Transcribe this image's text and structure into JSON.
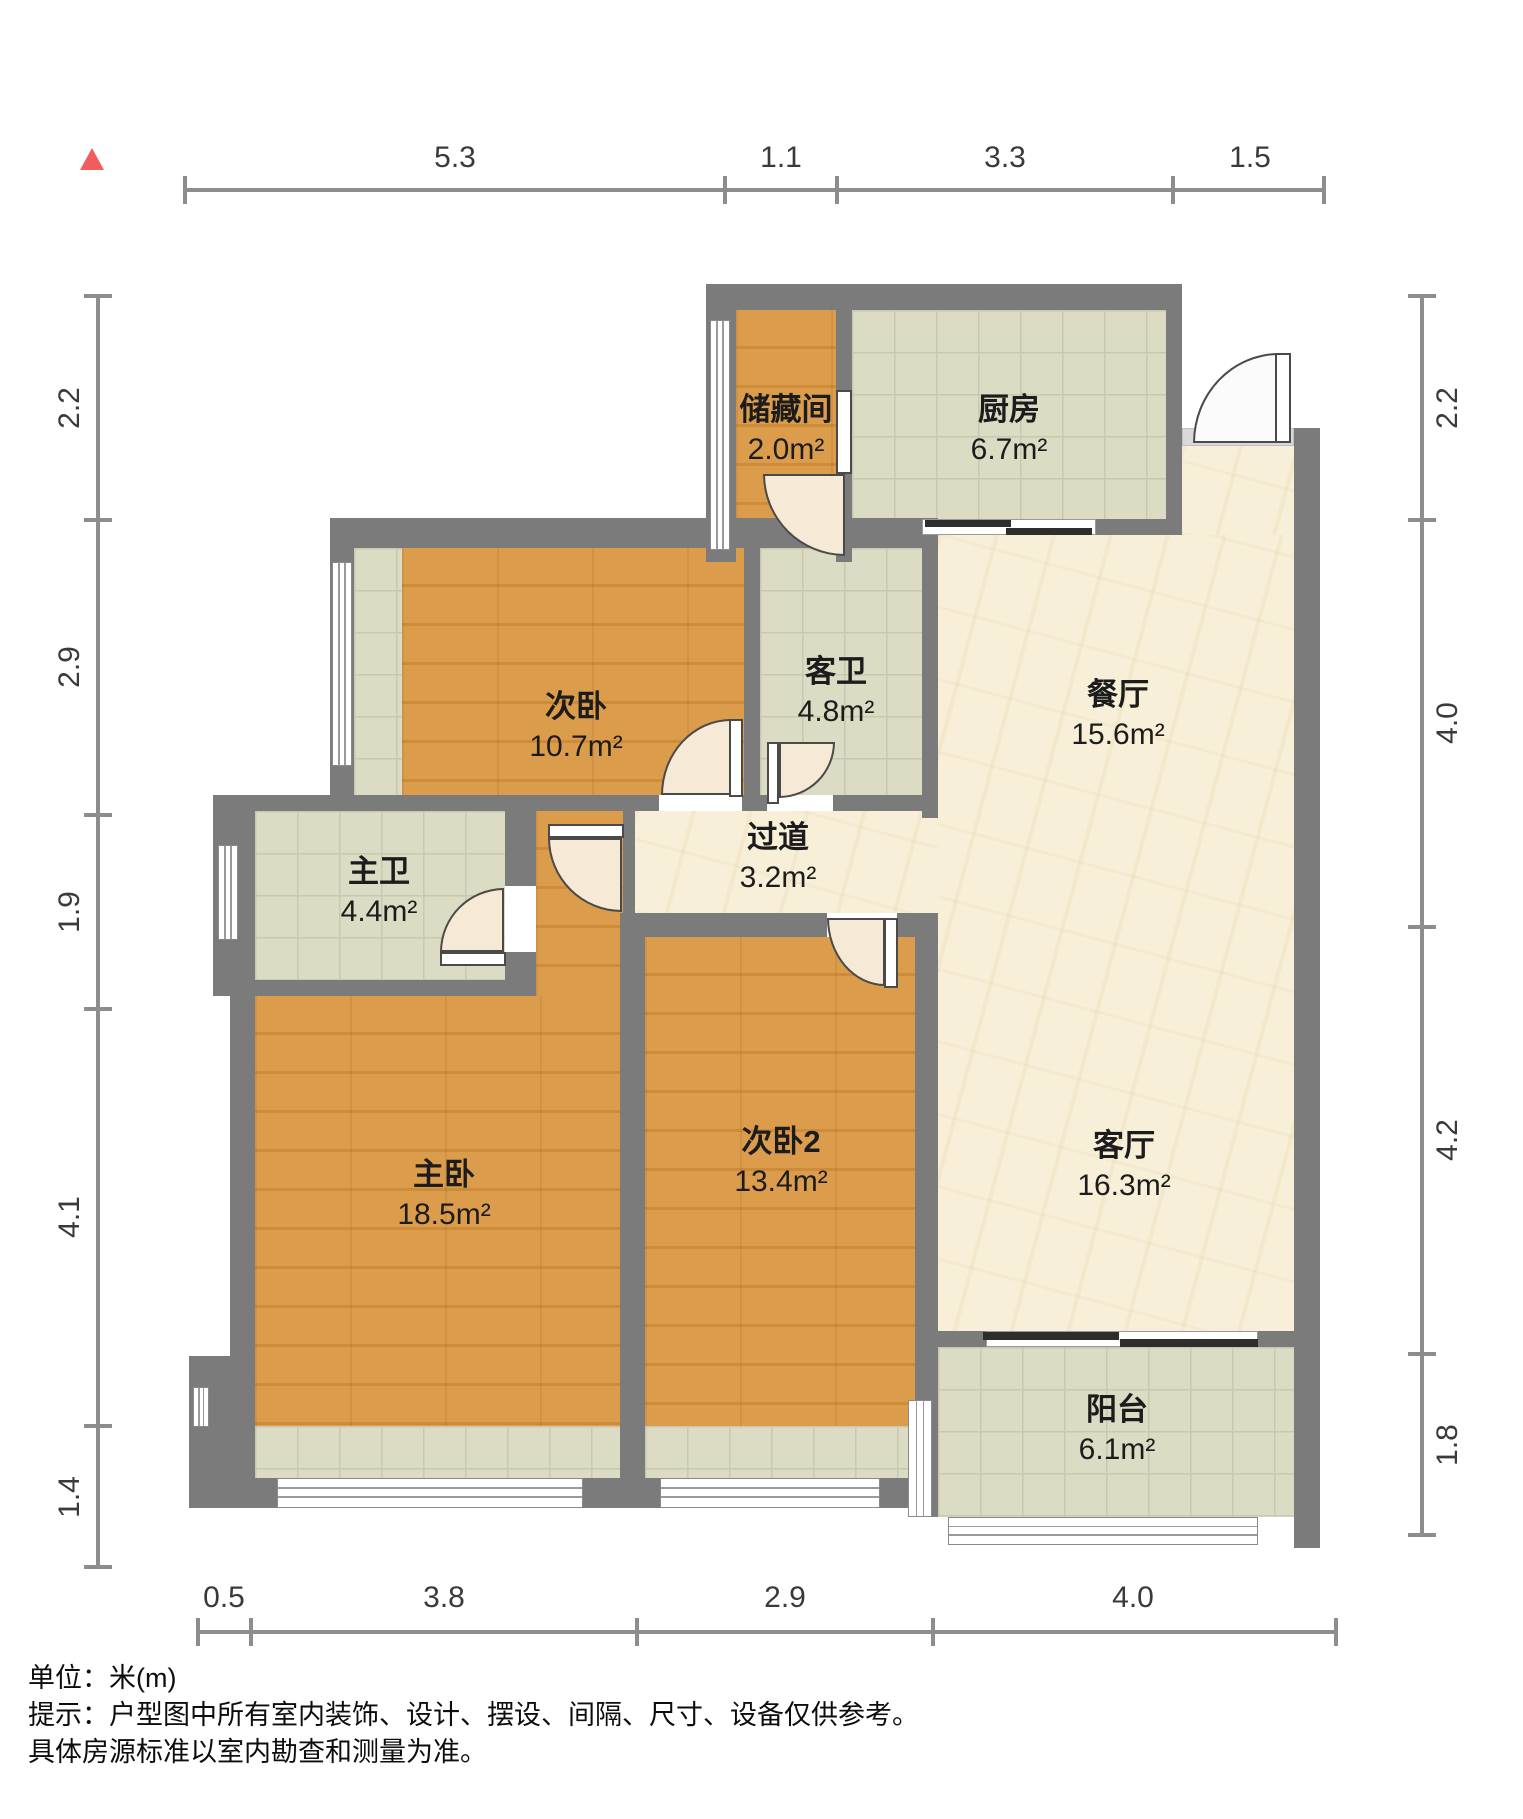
{
  "rooms": {
    "storage": {
      "name": "储藏间",
      "area": "2.0m²"
    },
    "kitchen": {
      "name": "厨房",
      "area": "6.7m²"
    },
    "bedroom2": {
      "name": "次卧",
      "area": "10.7m²"
    },
    "guest_bath": {
      "name": "客卫",
      "area": "4.8m²"
    },
    "dining": {
      "name": "餐厅",
      "area": "15.6m²"
    },
    "master_bath": {
      "name": "主卫",
      "area": "4.4m²"
    },
    "hallway": {
      "name": "过道",
      "area": "3.2m²"
    },
    "master_bedroom": {
      "name": "主卧",
      "area": "18.5m²"
    },
    "bedroom3": {
      "name": "次卧2",
      "area": "13.4m²"
    },
    "living": {
      "name": "客厅",
      "area": "16.3m²"
    },
    "balcony": {
      "name": "阳台",
      "area": "6.1m²"
    }
  },
  "dimensions": {
    "top": [
      "5.3",
      "1.1",
      "3.3",
      "1.5"
    ],
    "left": [
      "2.2",
      "2.9",
      "1.9",
      "4.1",
      "1.4"
    ],
    "right": [
      "2.2",
      "4.0",
      "4.2",
      "1.8"
    ],
    "bottom": [
      "0.5",
      "3.8",
      "2.9",
      "4.0"
    ]
  },
  "footer": {
    "unit": "单位：米(m)",
    "tip": "提示：户型图中所有室内装饰、设计、摆设、间隔、尺寸、设备仅供参考。",
    "tip2": "具体房源标准以室内勘查和测量为准。"
  },
  "colors": {
    "wall": "#7b7b7b",
    "wood": "#d2913c",
    "tile": "#dcdbc4",
    "marble": "#f7efd8",
    "north_marker": "#f25c5c"
  }
}
